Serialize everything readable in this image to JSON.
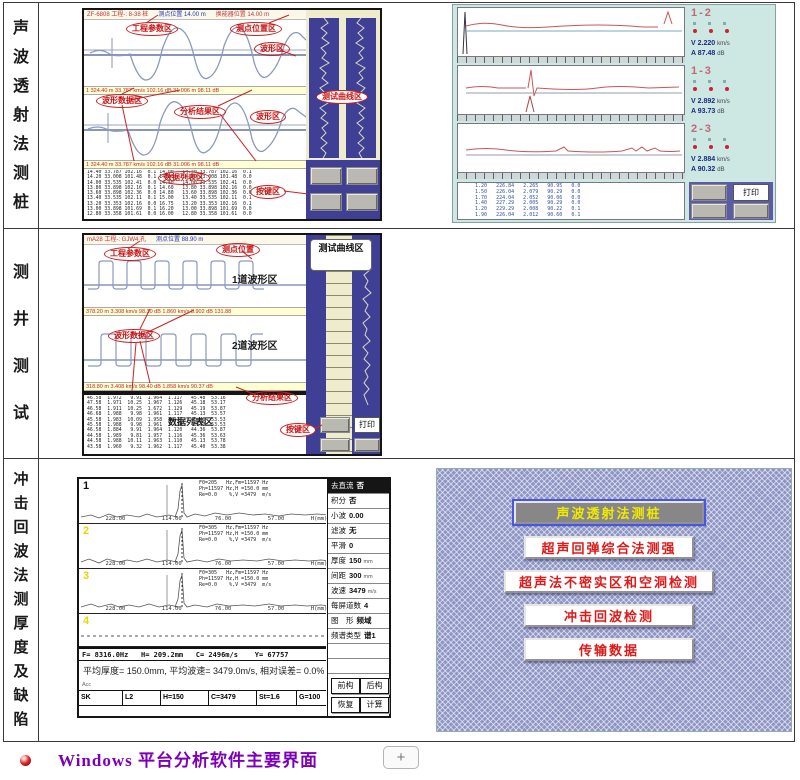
{
  "caption": {
    "text": "Windows 平台分析软件主要界面",
    "plus": "+"
  },
  "rows": [
    {
      "label": "声波透射法测桩"
    },
    {
      "label": "测井测试"
    },
    {
      "label": "冲击回波法测厚度及缺陷"
    }
  ],
  "pile_ui": {
    "title_left": "ZF-6808 工程-: 8-38 桩",
    "title_mid": "测点位置 14.00 m",
    "title_right": "换能器位置 14.00 m",
    "ann": {
      "project": "工程参数区",
      "point": "测点位置区",
      "wave": "波形区",
      "wavedata": "波形数据区",
      "analysis": "分析结果区",
      "wave2": "波形区",
      "curve": "测试曲线区",
      "datalist": "数据列表区",
      "keys": "按键区"
    },
    "status1": "1 324.40 m   33.787 km/s  102.16 dB         31.006 m  98.11 dB",
    "status2": "1 324.40 m   33.787 km/s  102.16 dB         31.006 m  98.11 dB",
    "table": "14.40 33.787 102.16  0.1 14.00   14.40 33.787 102.16  0.1\n14.20 33.008 101.48  0.1 14.20   14.20 33.008 101.48  0.0\n14.00 33.535 102.41  0.0 14.40   14.00 33.535 102.41  0.0\n13.80 33.898 102.16  0.1 14.60   13.80 33.898 102.16  0.0\n13.60 33.898 102.36  0.0 14.80   13.60 33.898 102.36  0.0\n13.40 33.535 102.11  0.1 15.00   13.40 33.535 102.11  0.1\n13.20 33.353 102.16  0.0 16.75   13.20 33.353 102.16  0.1\n13.00 33.898 101.69  0.1 16.20   13.00 33.898 101.69  0.0\n12.80 33.358 101.61  0.0 16.00   12.80 33.358 101.61  0.0"
  },
  "pile_result": {
    "panels": [
      {
        "id": "1-2",
        "v_label": "V",
        "v_value": "2.220",
        "v_unit": "km/s",
        "a_label": "A",
        "a_value": "87.48",
        "a_unit": "dB"
      },
      {
        "id": "1-3",
        "v_label": "V",
        "v_value": "2.892",
        "v_unit": "km/s",
        "a_label": "A",
        "a_value": "93.73",
        "a_unit": "dB"
      },
      {
        "id": "2-3",
        "v_label": "V",
        "v_value": "2.884",
        "v_unit": "km/s",
        "a_label": "A",
        "a_value": "90.32",
        "a_unit": "dB"
      }
    ],
    "print": "打印",
    "table": " 1.20   226.84   2.265   90.95   0.0\n 1.50   226.04   2.079   90.29   0.0\n 1.70   224.04   2.052   90.06   0.0\n 1.40   227.29   2.005   90.29   0.0\n 1.20   229.29   2.008   90.22   0.1\n 1.90   226.04   2.012   90.60   0.1"
  },
  "well_ui": {
    "title_left": "mA28 工程-: GJW4 孔",
    "title_mid": "测点位置 88.90 m",
    "ann": {
      "project": "工程参数区",
      "point": "测点位置",
      "ch1": "1道波形区",
      "wavedata": "波形数据区",
      "ch2": "2道波形区",
      "analysis": "分析结果区",
      "datalist": "数据列表区",
      "keys": "按键区",
      "curve": "测试曲线区"
    },
    "status1": "378.20 m  3.308 km/s  98.30 dB   1.860 km/s  8.902 dB   131.88",
    "status2": "318.80 m  3.408 km/s  98.40 dB   1.858 km/s  90.37 dB",
    "print": "打印",
    "table": "46.58  1.972   9.91  1.964  1.117   45.48  53.16\n47.58  1.971  10.25  1.967  1.126   45.18  53.17\n46.58  1.911  10.25  1.672  1.129   45.19  53.87\n46.68  1.988   9.98  1.961  1.117   45.13  53.57\n45.58  1.983  10.09  1.958  1.117   45.40  53.53\n45.58  1.988   9.98  1.961  1.117   45.13  53.53\n46.58  1.884   9.91  1.964  1.120   44.36  53.87\n44.58  1.989   9.81  1.957  1.116   45.36  53.63\n44.58  1.988  10.11  1.963  1.110   45.13  53.78\n43.58  1.960   9.32  1.962  1.117   45.40  53.38"
  },
  "impact_ui": {
    "traces": [
      {
        "num": "1",
        "info": "F0=205   Hz,Fm=11597 Hz\nPh=11597 Hz,H =150.0 mm\nRe=0.0    %,V =3479  m/s"
      },
      {
        "num": "2",
        "info": "F0=305   Hz,Fm=11597 Hz\nPh=11597 Hz,H =150.0 mm\nRe=0.0    %,V =3479  m/s"
      },
      {
        "num": "3",
        "info": "F0=305   Hz,Fm=11597 Hz\nPh=11597 Hz,H =150.0 mm\nRe=0.0    %,V =3479  m/s"
      },
      {
        "num": "4",
        "info": ""
      }
    ],
    "axis": "        228.00           114.00          76.00           57.00        H(mm)",
    "params": [
      {
        "label": "去直流",
        "value": "否",
        "unit": ""
      },
      {
        "label": "积分",
        "value": "否",
        "unit": ""
      },
      {
        "label": "小波",
        "value": "0.00",
        "unit": ""
      },
      {
        "label": "滤波",
        "value": "无",
        "unit": ""
      },
      {
        "label": "平滑",
        "value": "0",
        "unit": ""
      },
      {
        "label": "厚度",
        "value": "150",
        "unit": "mm"
      },
      {
        "label": "间距",
        "value": "300",
        "unit": "mm"
      },
      {
        "label": "波速",
        "value": "3479",
        "unit": "m/s"
      },
      {
        "label": "每屏道数",
        "value": "4",
        "unit": ""
      },
      {
        "label": "图　形",
        "value": "频域",
        "unit": ""
      },
      {
        "label": "频谱类型",
        "value": "谱1",
        "unit": ""
      }
    ],
    "buttons": [
      "前构",
      "后构",
      "恢复",
      "计算"
    ],
    "status1": "F= 8316.0Hz   H= 209.2mm   C= 2496m/s    Y= 67757",
    "status2": "平均厚度= 150.0mm, 平均波速= 3479.0m/s, 相对误差= 0.0%",
    "acc": "Acc",
    "footer": [
      "SK",
      "L2",
      "H=150",
      "C=3479",
      "St=1.6",
      "G=100"
    ]
  },
  "menu_ui": {
    "buttons": [
      {
        "label": "声波透射法测桩"
      },
      {
        "label": "超声回弹综合法测强"
      },
      {
        "label": "超声法不密实区和空洞检测"
      },
      {
        "label": "冲击回波检测"
      },
      {
        "label": "传输数据"
      }
    ]
  }
}
